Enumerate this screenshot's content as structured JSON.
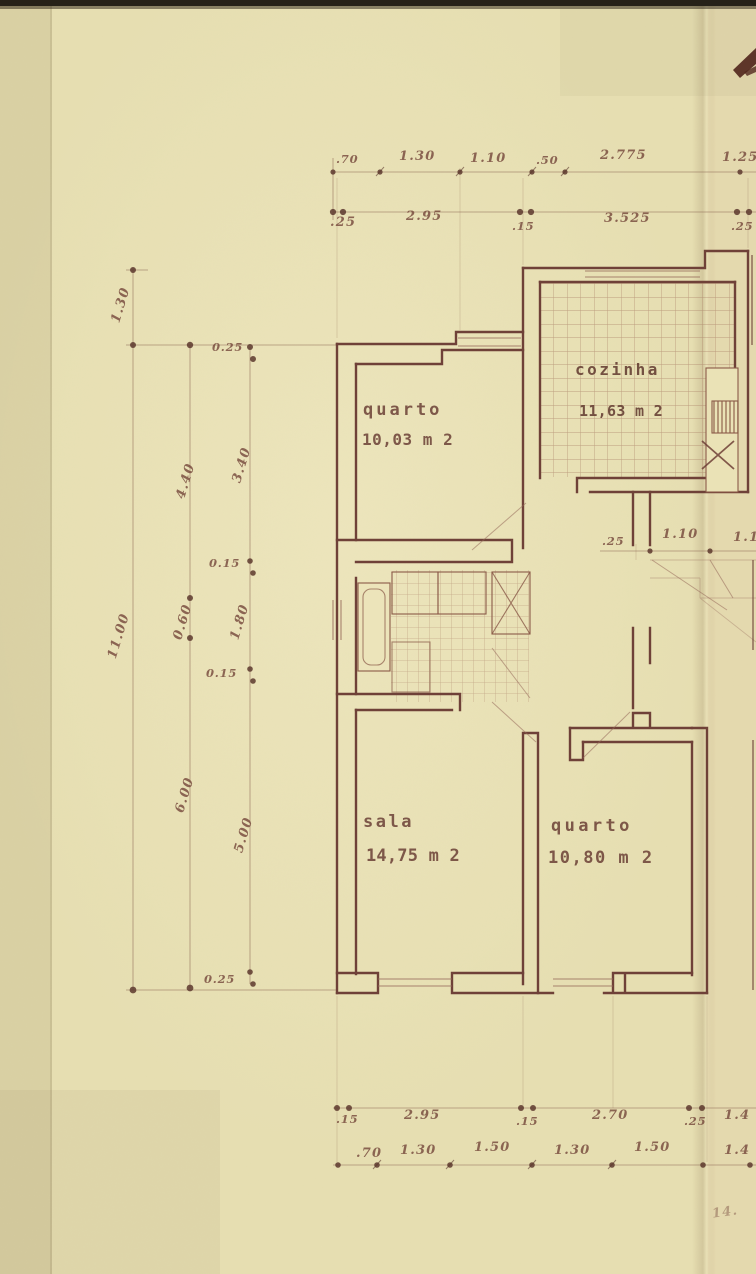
{
  "document": {
    "type": "scanned architectural floor plan",
    "accent_ink": "#6f4138",
    "paper_color": "#e7dfb2"
  },
  "rooms": [
    {
      "name": "quarto",
      "area": "10,03 m 2"
    },
    {
      "name": "cozinha",
      "area": "11,63 m 2"
    },
    {
      "name": "sala",
      "area": "14,75 m 2"
    },
    {
      "name": "quarto",
      "area": "10,80 m 2"
    }
  ],
  "dims": {
    "top1": [
      ".70",
      "1.30",
      "1.10",
      ".50",
      "2.775",
      "1.25"
    ],
    "top2": [
      ".25",
      "2.95",
      ".15",
      "3.525",
      ".25"
    ],
    "left_a": [
      "1.30",
      "11.00"
    ],
    "left_b": [
      "4.40",
      "0.60",
      "6.00"
    ],
    "left_c": [
      "0.25",
      "3.40",
      "0.15",
      "1.80",
      "0.15",
      "5.00",
      "0.25"
    ],
    "mid": [
      ".25",
      "1.10",
      "1.12"
    ],
    "bottom1": [
      ".15",
      "2.95",
      ".15",
      "2.70",
      ".25",
      "1.4"
    ],
    "bottom2": [
      ".70",
      "1.30",
      "1.50",
      "1.30",
      "1.50",
      "1.4"
    ],
    "note": "14."
  },
  "marks": {
    "stamp_fragment": "stamp-fragment",
    "scan_edge": "scanner-edge-band"
  }
}
